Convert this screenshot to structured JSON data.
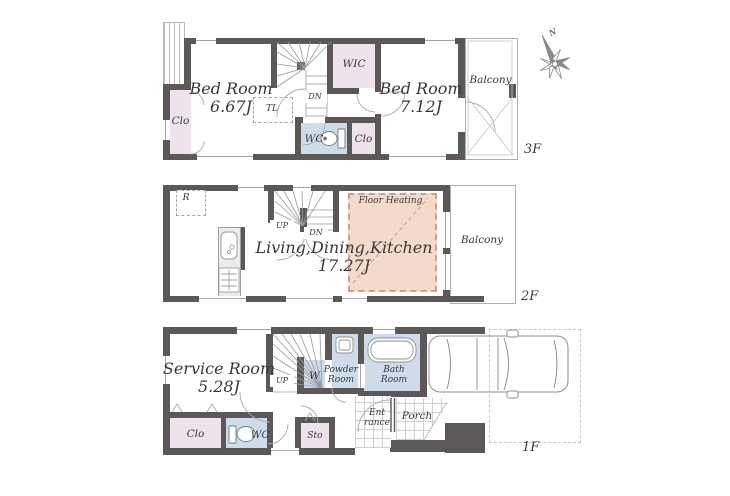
{
  "palette": {
    "wall": "#5b5857",
    "closet_pink": "#eee2ed",
    "wet_area_blue": "#cddbeb",
    "floor_heating_fill": "#f3dacb",
    "floor_heating_dash": "#d09e8e",
    "outline_gray": "#aeaeae",
    "text": "#3b3736"
  },
  "compass": {
    "north_label": "N"
  },
  "floor3": {
    "floor_label": "3F",
    "bedroom_left": {
      "name": "Bed Room",
      "size": "6.67J"
    },
    "bedroom_right": {
      "name": "Bed Room",
      "size": "7.12J"
    },
    "wic_label": "WIC",
    "closet_left_label": "Clo",
    "closet_hall_label": "Clo",
    "wc_label": "WC",
    "tl_label": "TL",
    "stairs_down_label": "DN",
    "balcony_label": "Balcony"
  },
  "floor2": {
    "floor_label": "2F",
    "refrigerator_label": "R",
    "stairs_up_label": "UP",
    "stairs_down_label": "DN",
    "ldk": {
      "name": "Living,Dining,Kitchen",
      "size": "17.27J"
    },
    "floor_heating_label": "Floor Heating",
    "balcony_label": "Balcony"
  },
  "floor1": {
    "floor_label": "1F",
    "service_room": {
      "name": "Service Room",
      "size": "5.28J"
    },
    "stairs_up_label": "UP",
    "washer_label": "W",
    "powder_room_label": "Powder Room",
    "bath_room_label": "Bath Room",
    "closet_label": "Clo",
    "wc_label": "WC",
    "storage_label": "Sto",
    "entrance_label": "Ent rance",
    "porch_label": "Porch"
  }
}
